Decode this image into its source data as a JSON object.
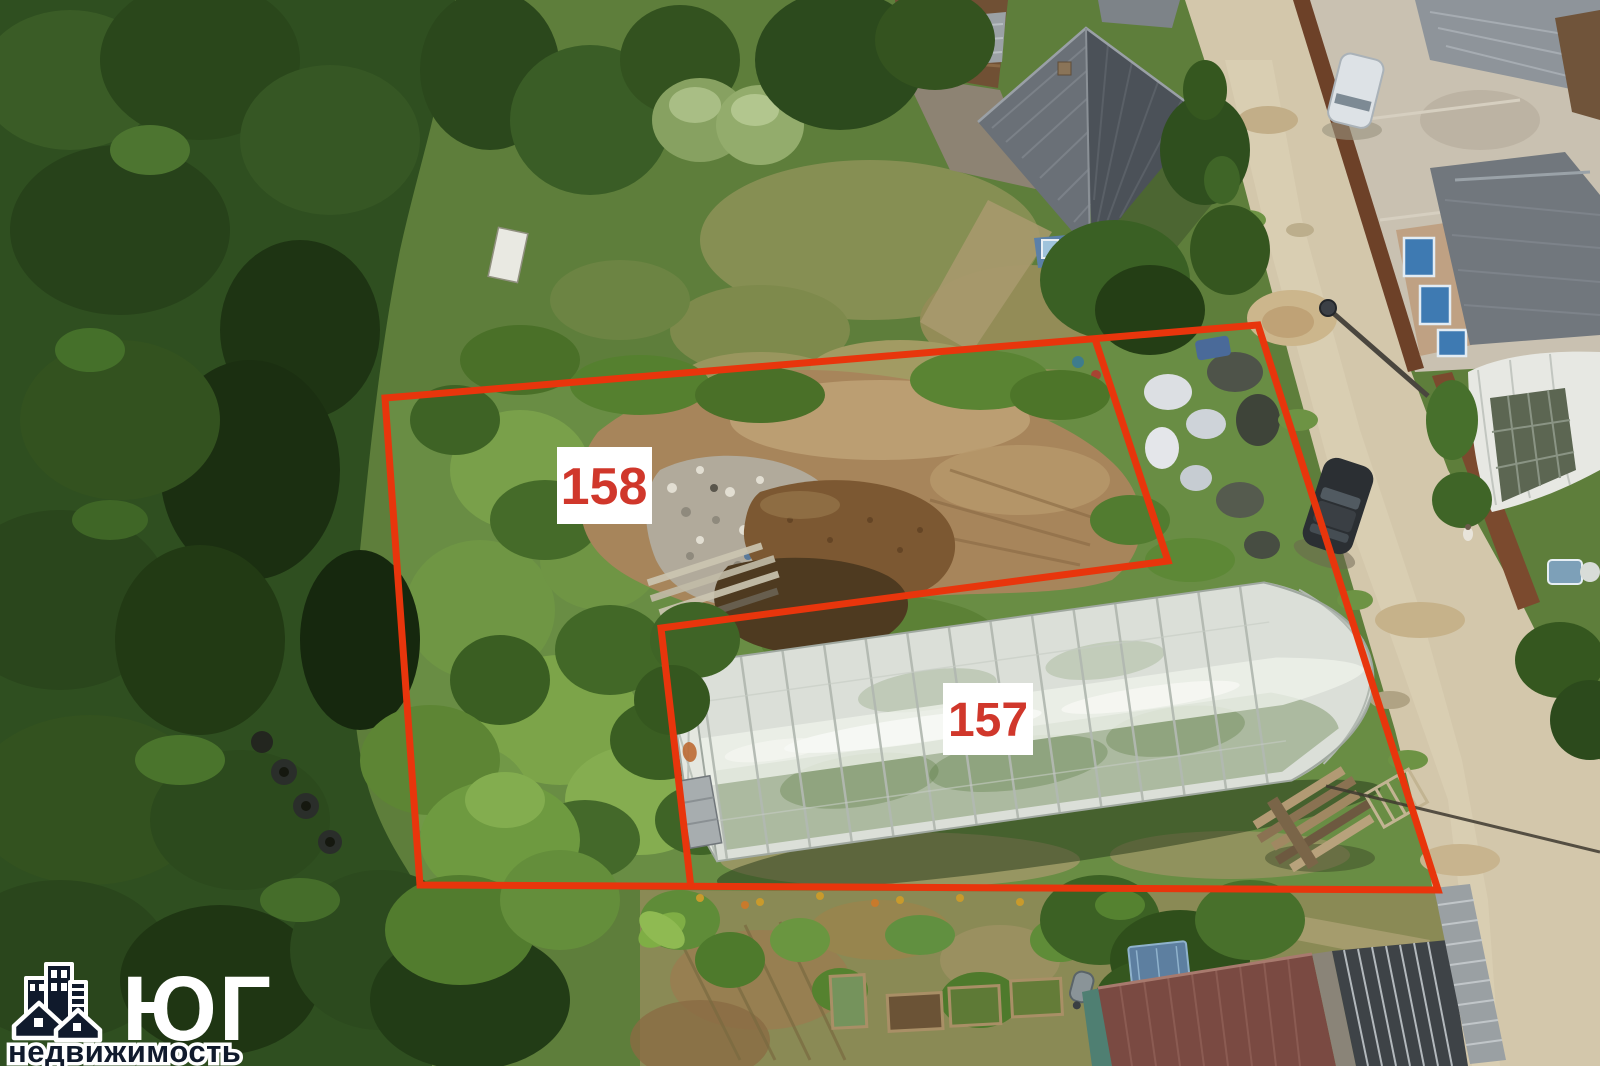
{
  "plots": {
    "left": {
      "label": "158"
    },
    "right": {
      "label": "157"
    }
  },
  "watermark": {
    "name": "ЮГ",
    "subtitle": "недвижимость"
  },
  "colors": {
    "boundary": "#e8350c",
    "plot_label_text": "#d0372b",
    "plot_label_background": "#ffffff",
    "watermark_text": "#ffffff",
    "watermark_subtitle_fill": "#101a2c",
    "watermark_outline": "#ffffff"
  },
  "icons": {
    "watermark_logo": "buildings-and-houses-icon"
  }
}
